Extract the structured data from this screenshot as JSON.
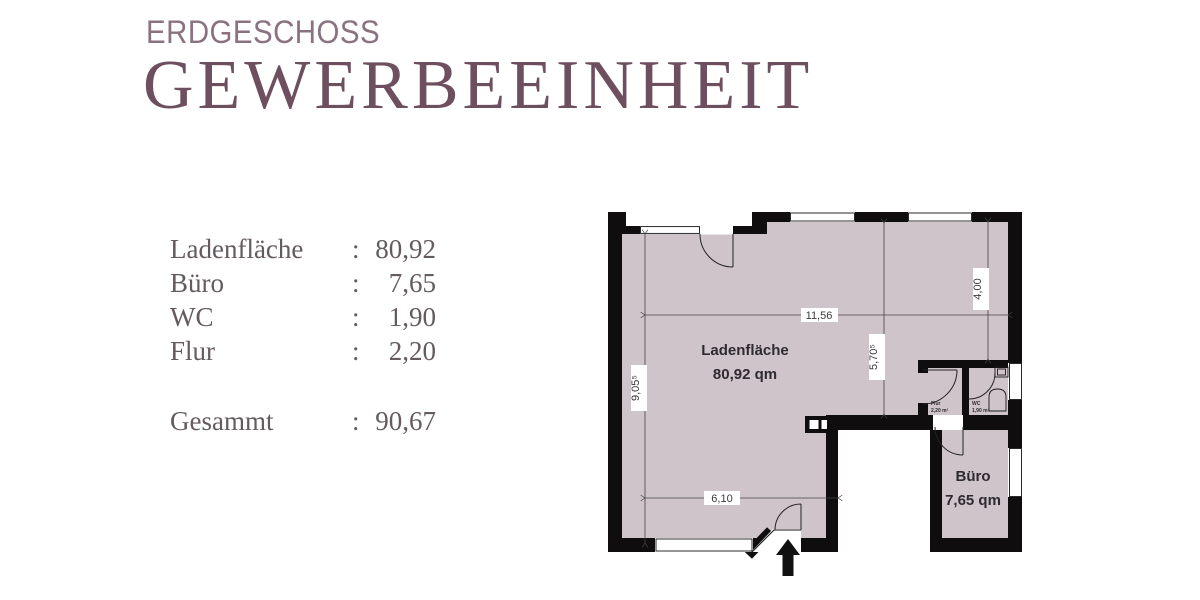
{
  "header": {
    "floor_label": "ERDGESCHOSS",
    "unit_title": "GEWERBEEINHEIT"
  },
  "area_table": {
    "colon": ":",
    "rows": [
      {
        "label": "Ladenfläche",
        "value": "80,92"
      },
      {
        "label": "Büro",
        "value": "7,65"
      },
      {
        "label": "WC",
        "value": "1,90"
      },
      {
        "label": "Flur",
        "value": "2,20"
      }
    ],
    "total": {
      "label": "Gesammt",
      "value": "90,67"
    }
  },
  "floor_plan": {
    "rooms": {
      "ladenflaeche": {
        "name": "Ladenfläche",
        "area": "80,92 qm"
      },
      "buero": {
        "name": "Büro",
        "area": "7,65 qm"
      },
      "flur": {
        "name": "Flur",
        "area": "2,20 m²"
      },
      "wc": {
        "name": "WC",
        "area": "1,90 m²"
      }
    },
    "dimensions": {
      "top_width": "11,56",
      "left_height": "9,05⁵",
      "middle_height": "5,70⁵",
      "right_height": "4,00",
      "bottom_width": "6,10"
    }
  },
  "colors": {
    "title_primary": "#6e4f5f",
    "title_secondary": "#8b7280",
    "legend_text": "#645a5f",
    "floor_fill": "#cfc4c9",
    "wall": "#0f0d0e"
  }
}
